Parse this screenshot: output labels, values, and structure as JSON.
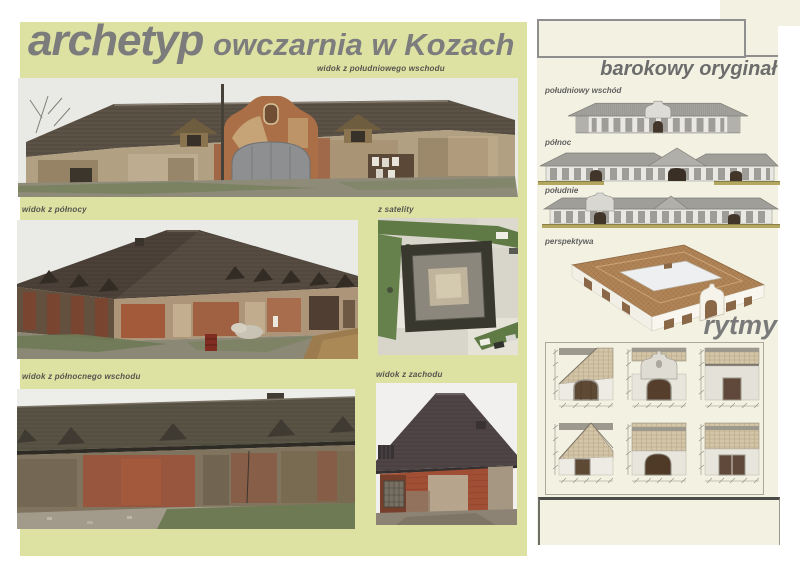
{
  "poster": {
    "brand": "archetyp",
    "title": "owczarnia w Kozach"
  },
  "captions": {
    "southeast": "widok z południowego wschodu",
    "north": "widok z północy",
    "satellite": "z satelity",
    "northeast": "widok z północnego wschodu",
    "west": "widok z zachodu"
  },
  "right_panel": {
    "heading": "barokowy oryginał",
    "labels": {
      "southeast_elevation": "południowy wschód",
      "north_elevation": "północ",
      "south_elevation": "południe",
      "perspective": "perspektywa"
    },
    "rytmy_heading": "rytmy"
  },
  "colors": {
    "left_panel_bg": "#dde2a2",
    "right_panel_bg": "#f3f2e2",
    "title_gray": "#7c7c7c",
    "label_gray": "#5f5f5f",
    "border_gray": "#8f8f8f",
    "roof_dark": "#4b4138",
    "brick_red": "#9c5736",
    "tile_tan": "#d3c5a8",
    "ground_olive": "#b3a65e"
  }
}
